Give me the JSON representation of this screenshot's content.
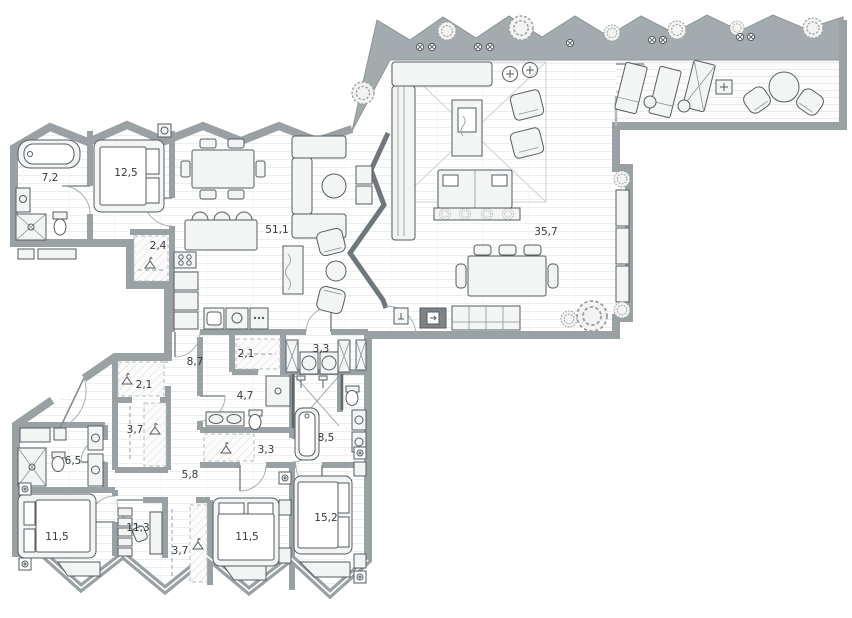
{
  "plan": {
    "kind": "apartment-floor-plan",
    "area_decimal_style": "comma"
  },
  "rooms": [
    {
      "name": "bathroom-master",
      "area": "7,2"
    },
    {
      "name": "bedroom-master",
      "area": "12,5"
    },
    {
      "name": "wardrobe-master",
      "area": "2,4"
    },
    {
      "name": "kitchen-living-room",
      "area": "51,1"
    },
    {
      "name": "living-dining-room",
      "area": "35,7"
    },
    {
      "name": "hallway-main",
      "area": "8,7"
    },
    {
      "name": "closet-hall",
      "area": "2,1"
    },
    {
      "name": "laundry",
      "area": "3,3"
    },
    {
      "name": "closet-west",
      "area": "2,1"
    },
    {
      "name": "bathroom-guest",
      "area": "4,7"
    },
    {
      "name": "wardrobe-west",
      "area": "3,7"
    },
    {
      "name": "closet-south",
      "area": "3,3"
    },
    {
      "name": "bathroom-children",
      "area": "8,5"
    },
    {
      "name": "bathroom-west",
      "area": "6,5"
    },
    {
      "name": "hallway-bedrooms",
      "area": "5,8"
    },
    {
      "name": "bedroom-west",
      "area": "11,5"
    },
    {
      "name": "bedroom-middle",
      "area": "11,3"
    },
    {
      "name": "wardrobe-bedroom",
      "area": "3,7"
    },
    {
      "name": "bedroom-south",
      "area": "11,5"
    },
    {
      "name": "bedroom-southeast",
      "area": "15,2"
    }
  ],
  "colors": {
    "wall": "#99a1a5",
    "wall_band": "#a4abae",
    "wall_dark": "#5f676c",
    "glass": "#b2babd",
    "floor": "#ffffff",
    "plank_line": "#ebeeee",
    "fixture_stroke": "#565c60",
    "fixture_fill": "#f3f4f4",
    "hatch": "#d3d7d9",
    "label_text": "#35393c"
  }
}
